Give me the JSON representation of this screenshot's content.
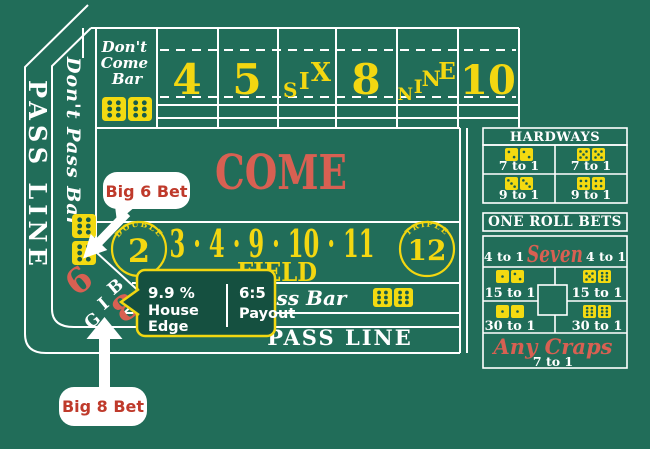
{
  "table": {
    "pass_line_left": "PASS LINE",
    "dont_pass_bar_left": "Don't Pass Bar",
    "dont_come_bar_lines": [
      "Don't",
      "Come",
      "Bar"
    ],
    "points": {
      "four": "4",
      "five": "5",
      "eight": "8",
      "ten": "10"
    },
    "six_letters": [
      "S",
      "I",
      "X"
    ],
    "nine_letters": [
      "N",
      "I",
      "N",
      "E"
    ],
    "come": "COME",
    "field": {
      "double": "DOUBLE",
      "two": "2",
      "numbers": "3 · 4 · 9 · 10 · 11",
      "label": "FIELD",
      "triple": "TRIPLE",
      "twelve": "12"
    },
    "big68": {
      "letters": [
        "B",
        "I",
        "G"
      ],
      "six": "6",
      "eight": "8"
    },
    "dont_pass_bar_bottom": "Don't Pass Bar",
    "pass_line_bottom": "PASS LINE"
  },
  "table_dice": {
    "dont_come": [
      6,
      6
    ],
    "dont_pass_left": [
      6,
      6
    ],
    "dont_pass_bottom": [
      6,
      6
    ]
  },
  "panels": {
    "hardways": {
      "title": "HARDWAYS",
      "cells": [
        {
          "dice": [
            2,
            2
          ],
          "odds": "7 to 1"
        },
        {
          "dice": [
            5,
            5
          ],
          "odds": "7 to 1"
        },
        {
          "dice": [
            3,
            3
          ],
          "odds": "9 to 1"
        },
        {
          "dice": [
            4,
            4
          ],
          "odds": "9 to 1"
        }
      ]
    },
    "one_roll": {
      "title": "ONE ROLL BETS",
      "seven": {
        "left_odds": "4 to 1",
        "label": "Seven",
        "right_odds": "4 to 1"
      },
      "cells": [
        {
          "dice": [
            1,
            2
          ],
          "odds": "15 to 1"
        },
        {
          "dice": [
            5,
            6
          ],
          "odds": "15 to 1"
        },
        {
          "dice": [
            1,
            1
          ],
          "odds": "30 to 1"
        },
        {
          "dice": [
            6,
            6
          ],
          "odds": "30 to 1"
        }
      ],
      "any_craps": {
        "label": "Any Craps",
        "odds": "7 to 1"
      }
    }
  },
  "annotations": {
    "big6_label": "Big 6 Bet",
    "big8_label": "Big 8 Bet",
    "tooltip": {
      "edge_value": "9.9 %",
      "edge_label_lines": [
        "House",
        "Edge"
      ],
      "payout_value": "6:5",
      "payout_label": "Payout"
    }
  },
  "colors": {
    "felt_green": "#216D59",
    "line_white": "#FFFFFF",
    "accent_yellow": "#F3D711",
    "table_salmon": "#D86052",
    "callout_red": "#BF3A2B",
    "tooltip_green": "#155040",
    "dice_yellow": "#F3DA11",
    "dice_pip_green": "#185C4A"
  }
}
